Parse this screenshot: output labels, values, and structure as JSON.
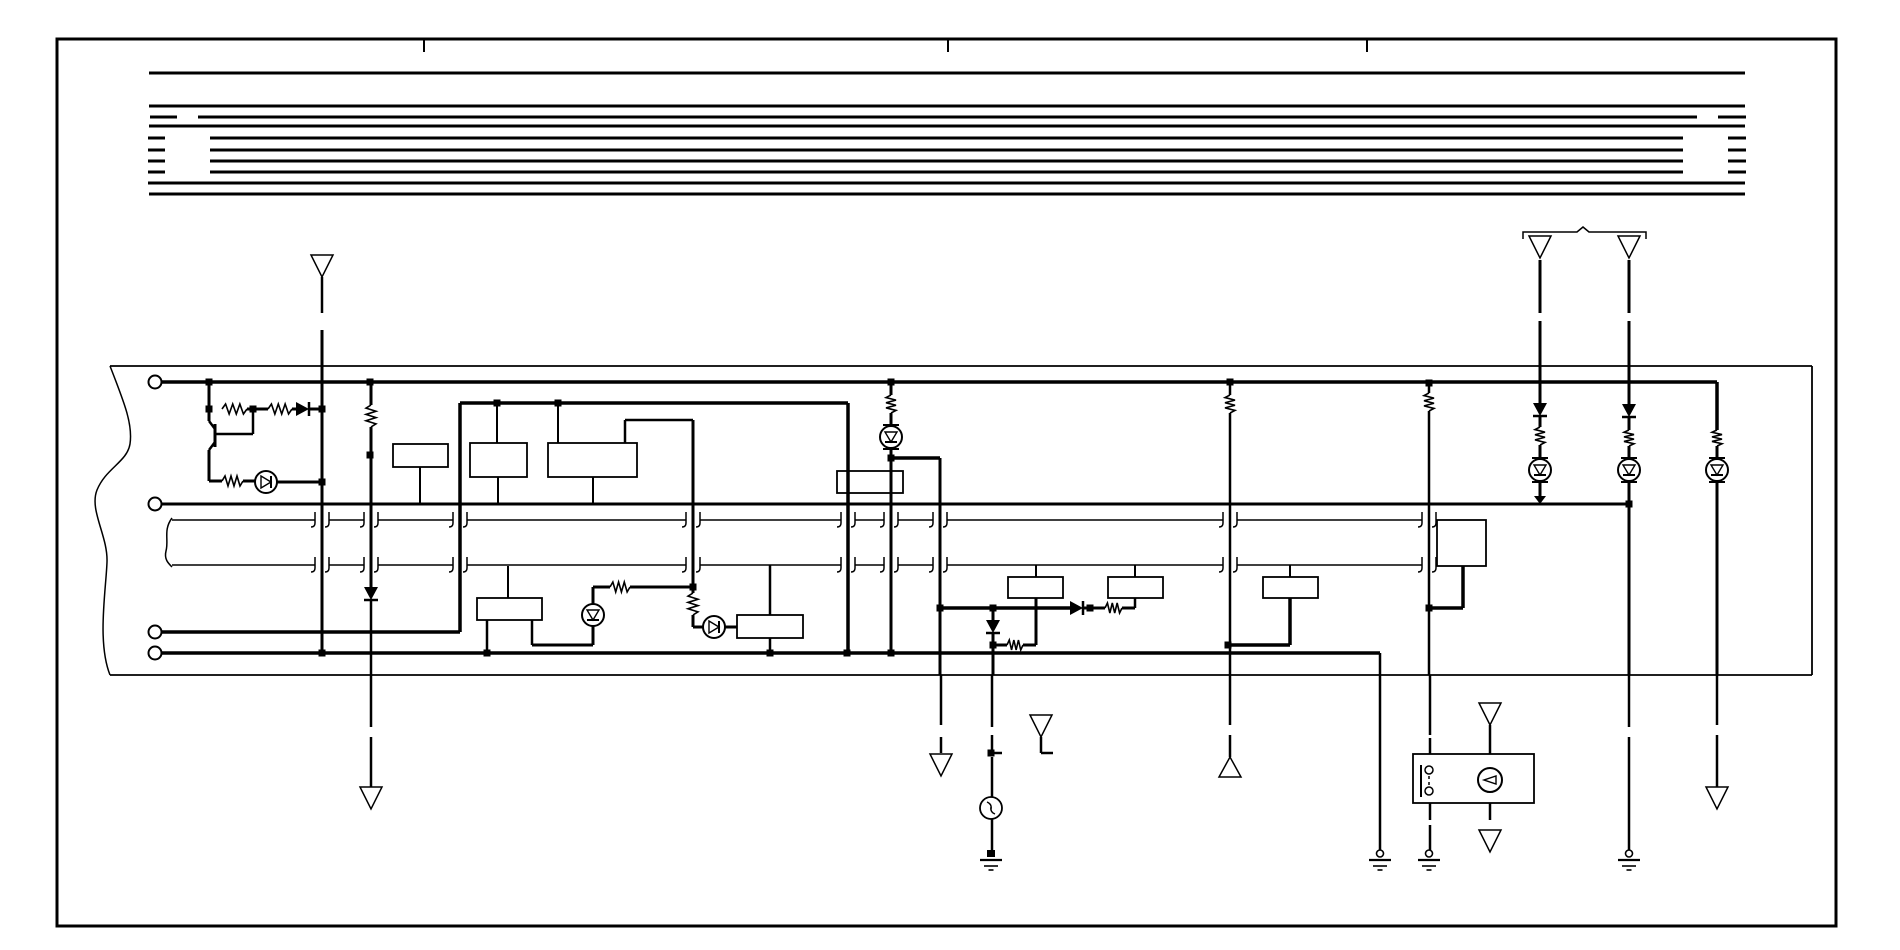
{
  "canvas": {
    "width": 1900,
    "height": 950,
    "bg": "#ffffff",
    "ink": "#000000"
  },
  "page": {
    "border": [
      57,
      39,
      1779,
      887
    ],
    "border_width": 3,
    "fold_ticks": [
      [
        424,
        39,
        52
      ],
      [
        948,
        39,
        52
      ],
      [
        1367,
        39,
        52
      ]
    ]
  },
  "harness": {
    "stroke_width": 3,
    "rows": [
      {
        "y": 73,
        "segs": [
          [
            149,
            1745
          ]
        ]
      },
      {
        "y": 106,
        "segs": [
          [
            149,
            1745
          ]
        ]
      },
      {
        "y": 117,
        "segs": [
          [
            150,
            177
          ],
          [
            198,
            1697
          ],
          [
            1718,
            1746
          ]
        ]
      },
      {
        "y": 126,
        "segs": [
          [
            149,
            1745
          ]
        ]
      },
      {
        "y": 138,
        "segs": [
          [
            148,
            165
          ],
          [
            210,
            1683
          ],
          [
            1728,
            1746
          ]
        ]
      },
      {
        "y": 150,
        "segs": [
          [
            148,
            165
          ],
          [
            210,
            1683
          ],
          [
            1728,
            1746
          ]
        ]
      },
      {
        "y": 161,
        "segs": [
          [
            148,
            165
          ],
          [
            210,
            1683
          ],
          [
            1728,
            1746
          ]
        ]
      },
      {
        "y": 172,
        "segs": [
          [
            148,
            165
          ],
          [
            210,
            1683
          ],
          [
            1728,
            1746
          ]
        ]
      },
      {
        "y": 183,
        "segs": [
          [
            148,
            1745
          ]
        ]
      },
      {
        "y": 194,
        "segs": [
          [
            149,
            1745
          ]
        ]
      }
    ]
  },
  "unit_outline": {
    "stroke_width": 1.8,
    "edges": [
      [
        110,
        366,
        1812,
        366
      ],
      [
        1812,
        366,
        1812,
        675
      ],
      [
        110,
        675,
        1812,
        675
      ]
    ],
    "left_torn_path": "M110,366 C124,402 133,424 130,444 C127,462 106,468 97,490 C89,510 108,536 107,562 C106,590 97,642 110,675",
    "band_torn_path": "M172,518 C163,530 169,540 166,551 C164,559 168,563 172,567"
  },
  "pins": [
    [
      155,
      382
    ],
    [
      155,
      504
    ],
    [
      155,
      632
    ],
    [
      155,
      653
    ]
  ],
  "band": {
    "rows": [
      520,
      565
    ],
    "stroke_width": 1.5,
    "segments": [
      [
        172,
        315
      ],
      [
        329,
        364
      ],
      [
        378,
        453
      ],
      [
        467,
        686
      ],
      [
        700,
        841
      ],
      [
        855,
        884
      ],
      [
        898,
        933
      ],
      [
        947,
        1223
      ],
      [
        1237,
        1422
      ]
    ],
    "crossings": [
      322,
      371,
      460,
      693,
      848,
      891,
      940,
      1230,
      1429
    ]
  },
  "wires": [
    [
      162,
      382,
      1717,
      382,
      3.5
    ],
    [
      162,
      504,
      1629,
      504,
      3
    ],
    [
      162,
      632,
      460,
      632,
      3.5
    ],
    [
      162,
      653,
      1380,
      653,
      3.5
    ],
    [
      460,
      403,
      848,
      403,
      3.5
    ],
    [
      460,
      403,
      460,
      632,
      3.5
    ],
    [
      848,
      403,
      848,
      653,
      3.5
    ],
    [
      322,
      277,
      322,
      313,
      2.5
    ],
    [
      322,
      330,
      322,
      653,
      3
    ],
    [
      371,
      382,
      371,
      405,
      3
    ],
    [
      371,
      427,
      371,
      587,
      3
    ],
    [
      371,
      600,
      371,
      727,
      2.5
    ],
    [
      371,
      737,
      371,
      787,
      2.5
    ],
    [
      209,
      382,
      209,
      421,
      3
    ],
    [
      253,
      409,
      253,
      434,
      2.5
    ],
    [
      215,
      434,
      253,
      434,
      2.5
    ],
    [
      209,
      450,
      209,
      481,
      3
    ],
    [
      209,
      481,
      222,
      481,
      3
    ],
    [
      243,
      481,
      255,
      481,
      3
    ],
    [
      277,
      482,
      322,
      482,
      3
    ],
    [
      247,
      409,
      268,
      409,
      3
    ],
    [
      292,
      409,
      296,
      409,
      3
    ],
    [
      309,
      409,
      322,
      409,
      3
    ],
    [
      497,
      403,
      497,
      443,
      2
    ],
    [
      558,
      403,
      558,
      443,
      2
    ],
    [
      625,
      420,
      625,
      443,
      2.5
    ],
    [
      625,
      420,
      693,
      420,
      2.5
    ],
    [
      693,
      420,
      693,
      593,
      3
    ],
    [
      693,
      615,
      693,
      627,
      3
    ],
    [
      693,
      627,
      703,
      627,
      3
    ],
    [
      725,
      627,
      737,
      627,
      3
    ],
    [
      593,
      587,
      610,
      587,
      3
    ],
    [
      630,
      587,
      693,
      587,
      3
    ],
    [
      593,
      587,
      593,
      604,
      3
    ],
    [
      593,
      626,
      593,
      645,
      3
    ],
    [
      532,
      645,
      593,
      645,
      3
    ],
    [
      532,
      620,
      532,
      645,
      2.5
    ],
    [
      487,
      620,
      487,
      653,
      2.5
    ],
    [
      508,
      566,
      508,
      598,
      2
    ],
    [
      420,
      467,
      420,
      504,
      2
    ],
    [
      498,
      477,
      498,
      504,
      2
    ],
    [
      593,
      477,
      593,
      504,
      2
    ],
    [
      770,
      565,
      770,
      615,
      2.5
    ],
    [
      770,
      638,
      770,
      653,
      2.5
    ],
    [
      891,
      382,
      891,
      395,
      3
    ],
    [
      891,
      413,
      891,
      426,
      3
    ],
    [
      891,
      448,
      891,
      653,
      3
    ],
    [
      891,
      458,
      940,
      458,
      3.5
    ],
    [
      940,
      458,
      940,
      608,
      3
    ],
    [
      940,
      608,
      940,
      675,
      3
    ],
    [
      941,
      675,
      941,
      725,
      2.5
    ],
    [
      941,
      737,
      941,
      753,
      2.5
    ],
    [
      940,
      608,
      1070,
      608,
      3.5
    ],
    [
      1083,
      608,
      1105,
      608,
      3
    ],
    [
      1122,
      608,
      1135,
      608,
      3
    ],
    [
      1135,
      598,
      1135,
      608,
      2.5
    ],
    [
      1036,
      565,
      1036,
      577,
      2
    ],
    [
      1135,
      565,
      1135,
      577,
      2
    ],
    [
      1036,
      598,
      1036,
      645,
      3
    ],
    [
      1023,
      645,
      1036,
      645,
      3
    ],
    [
      993,
      645,
      1007,
      645,
      3
    ],
    [
      993,
      608,
      993,
      620,
      3
    ],
    [
      993,
      633,
      993,
      675,
      3
    ],
    [
      992,
      675,
      992,
      727,
      2.5
    ],
    [
      992,
      735,
      992,
      750,
      2.5
    ],
    [
      991,
      753,
      1002,
      753,
      2.5
    ],
    [
      992,
      757,
      992,
      797,
      2.5
    ],
    [
      992,
      819,
      992,
      850,
      2.5
    ],
    [
      1230,
      382,
      1230,
      395,
      2.5
    ],
    [
      1230,
      413,
      1230,
      675,
      2.5
    ],
    [
      1230,
      675,
      1230,
      725,
      2.5
    ],
    [
      1230,
      735,
      1230,
      757,
      2.5
    ],
    [
      1228,
      645,
      1290,
      645,
      3.5
    ],
    [
      1290,
      598,
      1290,
      645,
      3.5
    ],
    [
      1290,
      565,
      1290,
      577,
      2
    ],
    [
      1380,
      653,
      1380,
      850,
      2.5
    ],
    [
      1429,
      383,
      1429,
      393,
      2.5
    ],
    [
      1429,
      411,
      1429,
      675,
      2.5
    ],
    [
      1430,
      675,
      1430,
      735,
      2.5
    ],
    [
      1430,
      738,
      1430,
      754,
      2.5
    ],
    [
      1430,
      803,
      1430,
      820,
      2.5
    ],
    [
      1430,
      825,
      1430,
      850,
      2.5
    ],
    [
      1429,
      608,
      1463,
      608,
      3.5
    ],
    [
      1463,
      566,
      1463,
      608,
      3.5
    ],
    [
      1540,
      260,
      1540,
      313,
      3
    ],
    [
      1540,
      321,
      1540,
      403,
      3
    ],
    [
      1540,
      417,
      1540,
      427,
      3
    ],
    [
      1540,
      445,
      1540,
      459,
      3
    ],
    [
      1540,
      481,
      1540,
      496,
      3
    ],
    [
      1629,
      260,
      1629,
      313,
      3
    ],
    [
      1629,
      321,
      1629,
      404,
      3
    ],
    [
      1629,
      418,
      1629,
      430,
      3
    ],
    [
      1629,
      446,
      1629,
      459,
      3
    ],
    [
      1629,
      481,
      1629,
      675,
      3
    ],
    [
      1629,
      675,
      1629,
      727,
      2.5
    ],
    [
      1629,
      737,
      1629,
      850,
      2.5
    ],
    [
      1717,
      382,
      1717,
      430,
      3.5
    ],
    [
      1717,
      446,
      1717,
      459,
      3
    ],
    [
      1717,
      481,
      1717,
      675,
      3
    ],
    [
      1717,
      675,
      1717,
      725,
      2.5
    ],
    [
      1717,
      735,
      1717,
      787,
      2.5
    ],
    [
      1490,
      725,
      1490,
      754,
      2.5
    ],
    [
      1490,
      803,
      1490,
      820,
      2.5
    ],
    [
      1041,
      737,
      1041,
      753,
      2.5
    ],
    [
      1041,
      753,
      1053,
      753,
      2.5
    ]
  ],
  "boxes": [
    [
      393,
      444,
      55,
      23
    ],
    [
      470,
      443,
      57,
      34
    ],
    [
      548,
      443,
      89,
      34
    ],
    [
      837,
      471,
      66,
      22
    ],
    [
      737,
      615,
      66,
      23
    ],
    [
      477,
      598,
      65,
      22
    ],
    [
      1008,
      577,
      55,
      21
    ],
    [
      1108,
      577,
      55,
      21
    ],
    [
      1263,
      577,
      55,
      21
    ],
    [
      1437,
      520,
      49,
      46
    ],
    [
      1413,
      754,
      121,
      49
    ]
  ],
  "dots": [
    [
      209,
      382
    ],
    [
      370,
      382
    ],
    [
      891,
      382
    ],
    [
      1230,
      382
    ],
    [
      1429,
      383
    ],
    [
      209,
      409
    ],
    [
      253,
      409
    ],
    [
      322,
      409
    ],
    [
      370,
      455
    ],
    [
      891,
      458
    ],
    [
      322,
      482
    ],
    [
      497,
      403
    ],
    [
      558,
      403
    ],
    [
      693,
      587
    ],
    [
      940,
      608
    ],
    [
      993,
      608
    ],
    [
      1090,
      608
    ],
    [
      1429,
      608
    ],
    [
      993,
      645
    ],
    [
      1228,
      645
    ],
    [
      322,
      653
    ],
    [
      487,
      653
    ],
    [
      770,
      653
    ],
    [
      847,
      653
    ],
    [
      891,
      653
    ],
    [
      1629,
      504
    ],
    [
      991,
      753
    ]
  ],
  "resistors": [
    {
      "x": 222,
      "y": 409,
      "o": "h",
      "l": 25
    },
    {
      "x": 268,
      "y": 409,
      "o": "h",
      "l": 24
    },
    {
      "x": 222,
      "y": 481,
      "o": "h",
      "l": 21
    },
    {
      "x": 610,
      "y": 587,
      "o": "h",
      "l": 20
    },
    {
      "x": 1105,
      "y": 608,
      "o": "h",
      "l": 17
    },
    {
      "x": 1007,
      "y": 645,
      "o": "h",
      "l": 16
    },
    {
      "x": 371,
      "y": 405,
      "o": "v",
      "l": 22
    },
    {
      "x": 891,
      "y": 395,
      "o": "v",
      "l": 18
    },
    {
      "x": 1230,
      "y": 395,
      "o": "v",
      "l": 18
    },
    {
      "x": 693,
      "y": 593,
      "o": "v",
      "l": 22
    },
    {
      "x": 1429,
      "y": 393,
      "o": "v",
      "l": 18
    },
    {
      "x": 1540,
      "y": 427,
      "o": "v",
      "l": 18
    },
    {
      "x": 1629,
      "y": 430,
      "o": "v",
      "l": 16
    },
    {
      "x": 1717,
      "y": 430,
      "o": "v",
      "l": 16
    }
  ],
  "diodes": [
    {
      "x": 296,
      "y": 409,
      "dir": "right"
    },
    {
      "x": 1070,
      "y": 608,
      "dir": "right"
    },
    {
      "x": 371,
      "y": 587,
      "dir": "down"
    },
    {
      "x": 993,
      "y": 620,
      "dir": "down"
    },
    {
      "x": 1540,
      "y": 403,
      "dir": "down"
    },
    {
      "x": 1629,
      "y": 404,
      "dir": "down"
    }
  ],
  "arrows": [
    {
      "x": 1540,
      "y": 496,
      "dir": "down"
    }
  ],
  "lamps": [
    {
      "x": 266,
      "y": 482,
      "tri": "right",
      "ticks": false
    },
    {
      "x": 593,
      "y": 615,
      "tri": "down",
      "ticks": false
    },
    {
      "x": 714,
      "y": 627,
      "tri": "right",
      "ticks": false
    },
    {
      "x": 891,
      "y": 437,
      "tri": "down",
      "ticks": true
    },
    {
      "x": 1540,
      "y": 470,
      "tri": "down",
      "ticks": true
    },
    {
      "x": 1629,
      "y": 470,
      "tri": "down",
      "ticks": true
    },
    {
      "x": 1717,
      "y": 470,
      "tri": "down",
      "ticks": true
    }
  ],
  "bulb": {
    "x": 991,
    "y": 808,
    "r": 11
  },
  "triangles": [
    {
      "x": 322,
      "y": 255,
      "dir": "down"
    },
    {
      "x": 1540,
      "y": 236,
      "dir": "down"
    },
    {
      "x": 1629,
      "y": 236,
      "dir": "down"
    },
    {
      "x": 371,
      "y": 787,
      "dir": "down"
    },
    {
      "x": 941,
      "y": 754,
      "dir": "down"
    },
    {
      "x": 1041,
      "y": 715,
      "dir": "down"
    },
    {
      "x": 1490,
      "y": 703,
      "dir": "down"
    },
    {
      "x": 1490,
      "y": 830,
      "dir": "down"
    },
    {
      "x": 1717,
      "y": 787,
      "dir": "down"
    },
    {
      "x": 1230,
      "y": 757,
      "dir": "up"
    }
  ],
  "grounds": [
    {
      "x": 991,
      "y": 850,
      "top": "square"
    },
    {
      "x": 1380,
      "y": 850,
      "top": "circle"
    },
    {
      "x": 1429,
      "y": 850,
      "top": "circle"
    },
    {
      "x": 1629,
      "y": 850,
      "top": "circle"
    }
  ],
  "transistor": {
    "bar": [
      215,
      424,
      215,
      447
    ],
    "collector": [
      209,
      421,
      215,
      429
    ],
    "emitter": [
      215,
      442,
      209,
      450
    ]
  },
  "switch": {
    "bar": [
      1421,
      765,
      1421,
      797
    ],
    "contacts": [
      [
        1429,
        770
      ],
      [
        1429,
        791
      ]
    ],
    "dash": [
      1429,
      776,
      1429,
      786
    ]
  },
  "e_circle": {
    "x": 1490,
    "y": 780,
    "r": 12
  },
  "bracket_path": "M1523,239 L1523,232 L1577,232 L1583,227 L1589,232 L1646,232 L1646,239"
}
